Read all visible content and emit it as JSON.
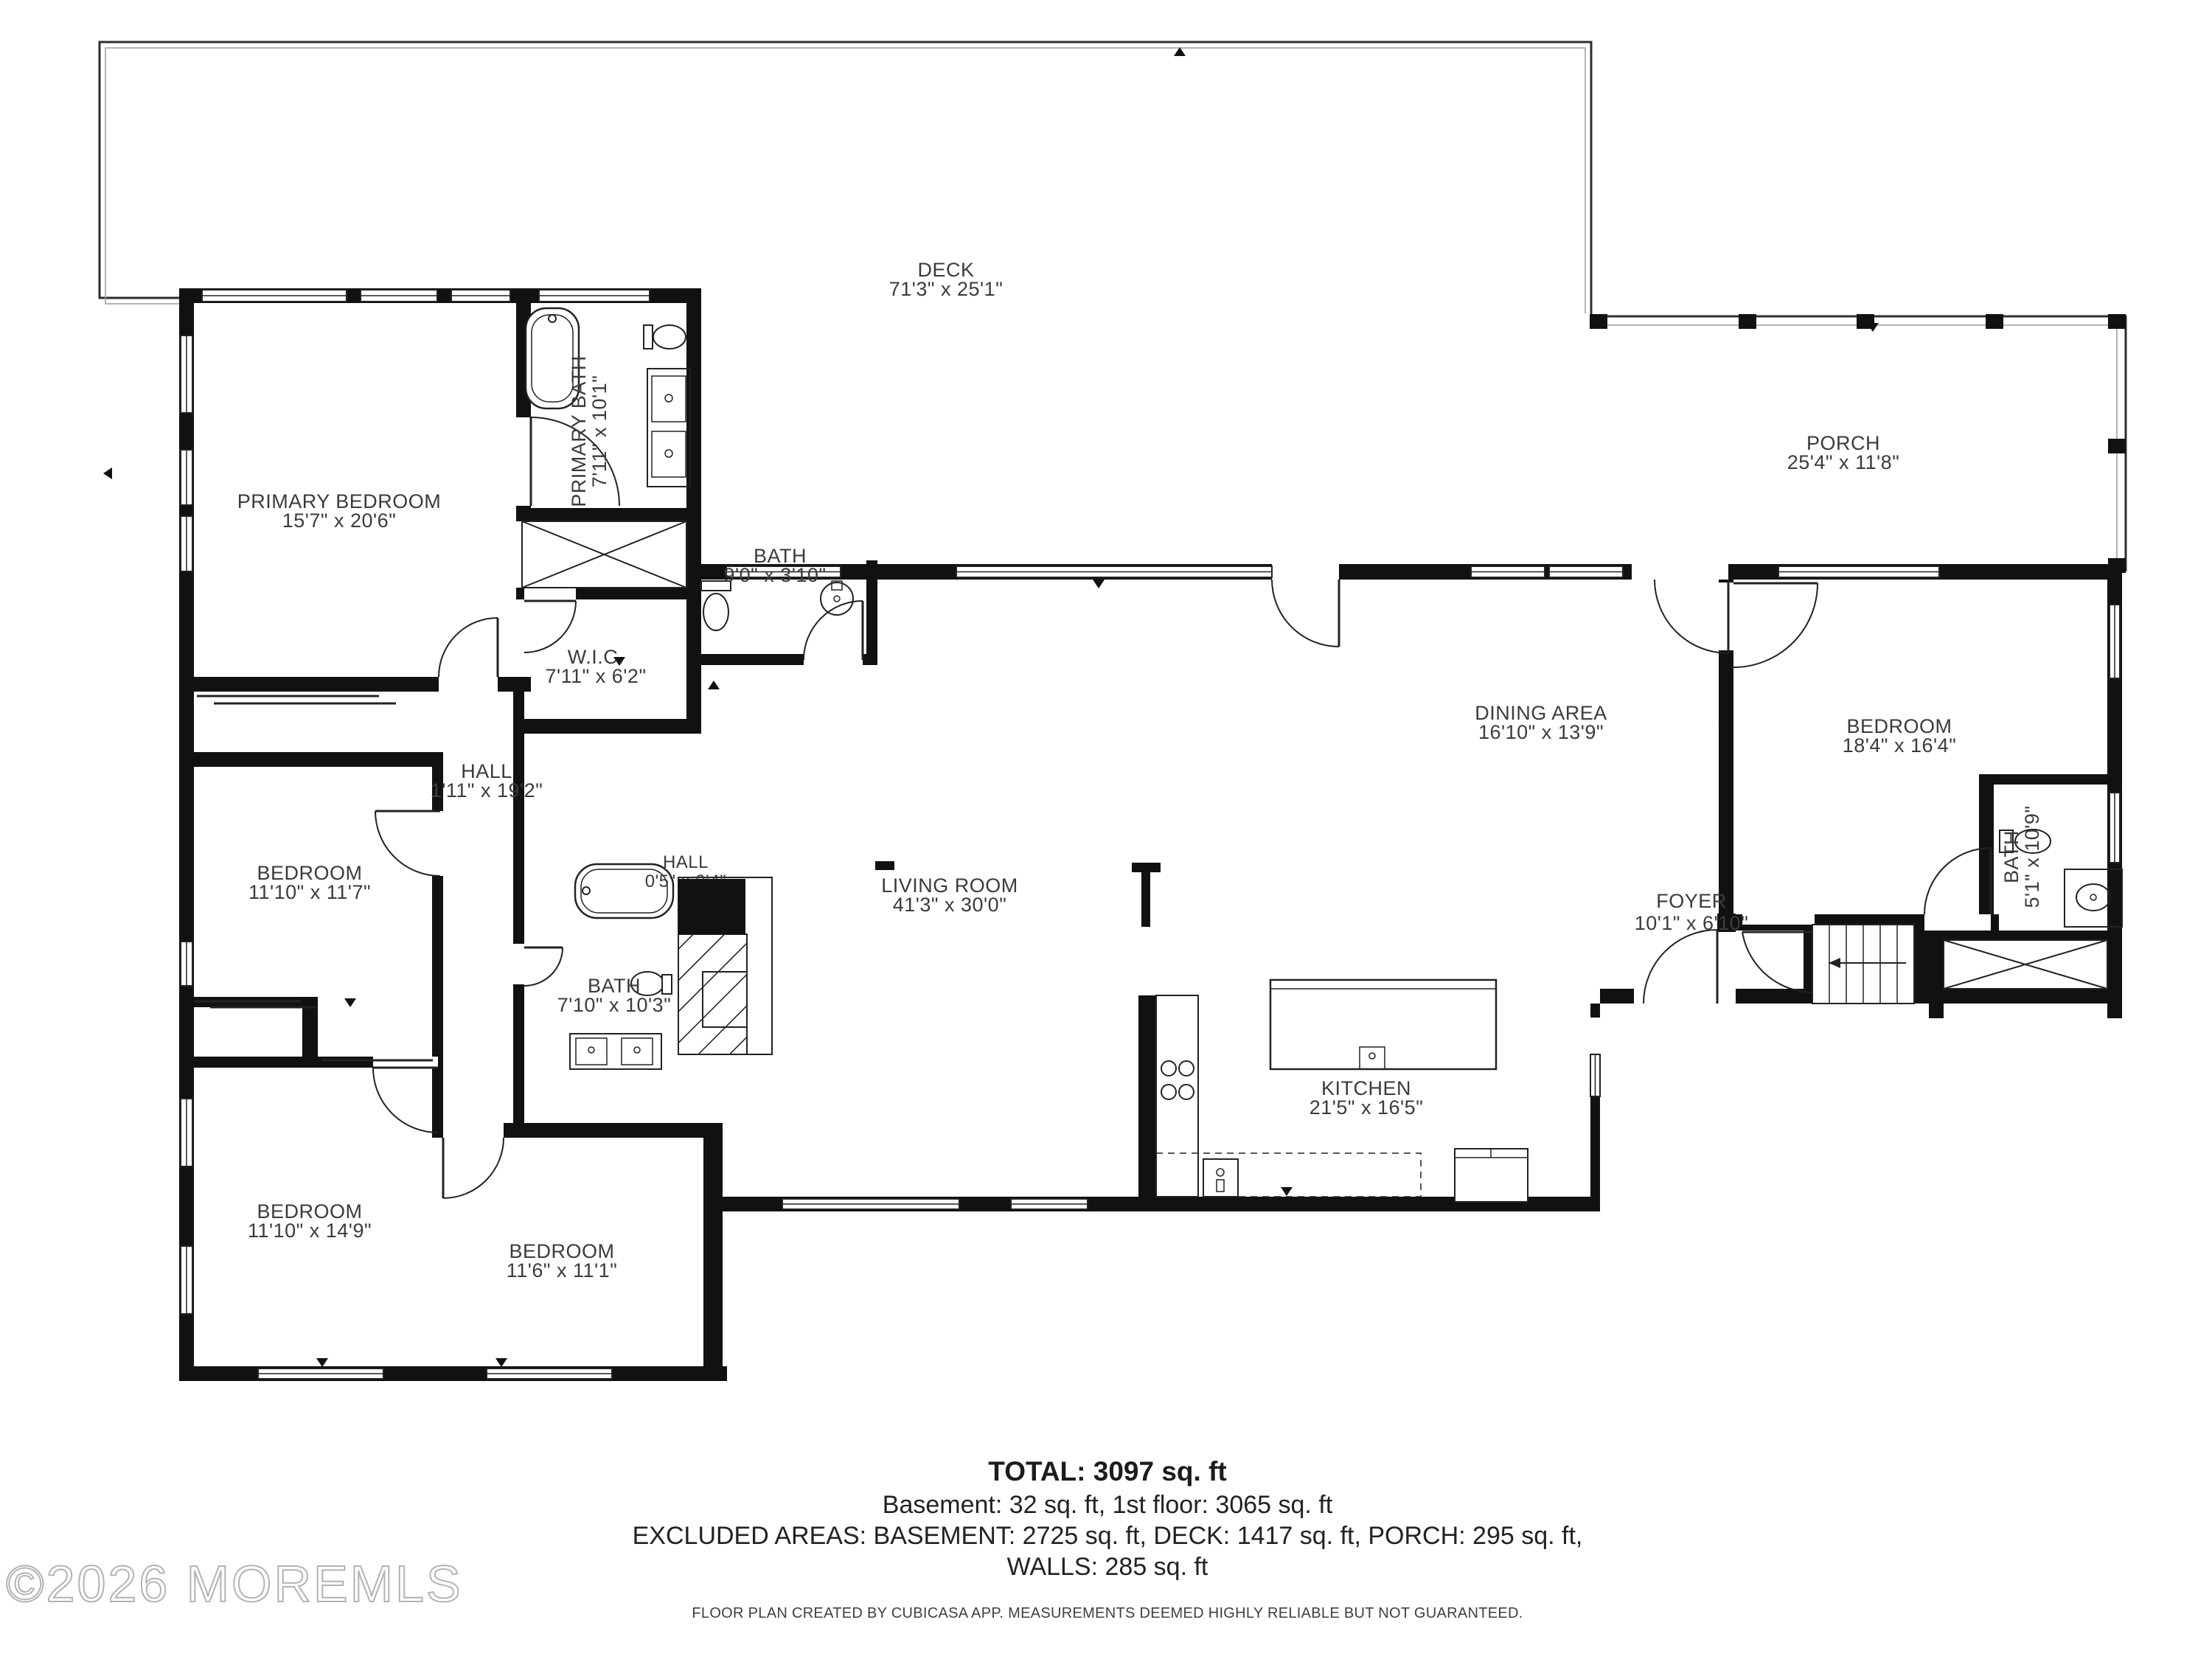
{
  "plan": {
    "rooms": [
      {
        "id": "deck",
        "name": "DECK",
        "dims": "71'3\" x 25'1\""
      },
      {
        "id": "porch",
        "name": "PORCH",
        "dims": "25'4\" x 11'8\""
      },
      {
        "id": "primary-bedroom",
        "name": "PRIMARY BEDROOM",
        "dims": "15'7\" x 20'6\""
      },
      {
        "id": "primary-bath",
        "name": "PRIMARY BATH",
        "dims": "7'11\" x 10'1\""
      },
      {
        "id": "bath-top",
        "name": "BATH",
        "dims": "9'0\" x 3'10\""
      },
      {
        "id": "wic",
        "name": "W.I.C.",
        "dims": "7'11\" x 6'2\""
      },
      {
        "id": "hall",
        "name": "HALL",
        "dims": "1'11\" x 19'2\""
      },
      {
        "id": "hall-small",
        "name": "HALL",
        "dims": "0'5\" x 9'4\""
      },
      {
        "id": "bedroom-mid-left",
        "name": "BEDROOM",
        "dims": "11'10\" x 11'7\""
      },
      {
        "id": "bath-mid",
        "name": "BATH",
        "dims": "7'10\" x 10'3\""
      },
      {
        "id": "living-room",
        "name": "LIVING ROOM",
        "dims": "41'3\" x 30'0\""
      },
      {
        "id": "dining-area",
        "name": "DINING AREA",
        "dims": "16'10\" x 13'9\""
      },
      {
        "id": "bedroom-right",
        "name": "BEDROOM",
        "dims": "18'4\" x 16'4\""
      },
      {
        "id": "foyer",
        "name": "FOYER",
        "dims": "10'1\" x 6'10\""
      },
      {
        "id": "bath-right",
        "name": "BATH",
        "dims": "5'1\" x 10'9\""
      },
      {
        "id": "kitchen",
        "name": "KITCHEN",
        "dims": "21'5\" x 16'5\""
      },
      {
        "id": "bedroom-bottom-left",
        "name": "BEDROOM",
        "dims": "11'10\" x 14'9\""
      },
      {
        "id": "bedroom-bottom-center",
        "name": "BEDROOM",
        "dims": "11'6\" x 11'1\""
      }
    ],
    "summary": {
      "total": "TOTAL: 3097 sq. ft",
      "line2": "Basement: 32 sq. ft, 1st floor: 3065 sq. ft",
      "line3": "EXCLUDED AREAS: BASEMENT: 2725 sq. ft, DECK: 1417 sq. ft, PORCH: 295 sq. ft,",
      "line4": "WALLS: 285 sq. ft"
    },
    "disclaimer": "FLOOR PLAN CREATED BY CUBICASA APP. MEASUREMENTS DEEMED HIGHLY RELIABLE BUT NOT GUARANTEED.",
    "watermark": "©2026 MOREMLS",
    "colors": {
      "wall": "#111111",
      "line": "#2a2a2a",
      "text": "#3b3b3b",
      "watermark": "#b3b3b3",
      "bg": "#ffffff"
    }
  }
}
